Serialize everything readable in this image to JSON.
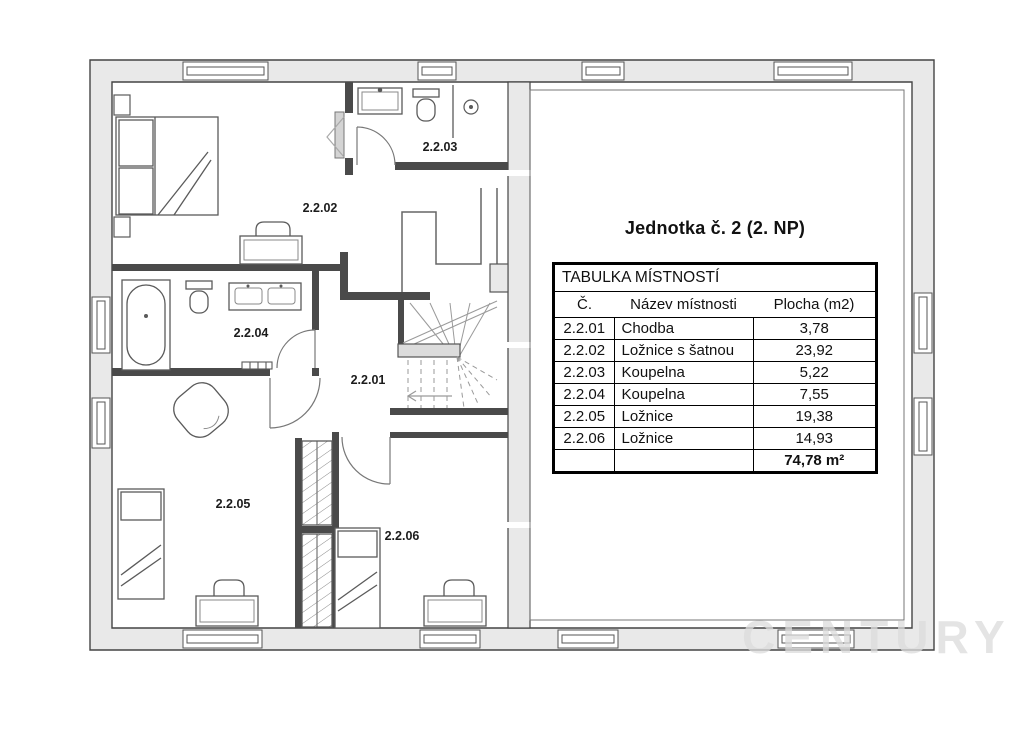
{
  "title": "Jednotka č. 2 (2. NP)",
  "table": {
    "caption": "TABULKA MÍSTNOSTÍ",
    "columns": [
      "Č.",
      "Název místnosti",
      "Plocha (m2)"
    ],
    "rows": [
      {
        "no": "2.2.01",
        "name": "Chodba",
        "area": "3,78"
      },
      {
        "no": "2.2.02",
        "name": "Ložnice s šatnou",
        "area": "23,92"
      },
      {
        "no": "2.2.03",
        "name": "Koupelna",
        "area": "5,22"
      },
      {
        "no": "2.2.04",
        "name": "Koupelna",
        "area": "7,55"
      },
      {
        "no": "2.2.05",
        "name": "Ložnice",
        "area": "19,38"
      },
      {
        "no": "2.2.06",
        "name": "Ložnice",
        "area": "14,93"
      }
    ],
    "total_area": "74,78 m²"
  },
  "plan": {
    "rooms": [
      {
        "label": "2.2.01"
      },
      {
        "label": "2.2.02"
      },
      {
        "label": "2.2.03"
      },
      {
        "label": "2.2.04"
      },
      {
        "label": "2.2.05"
      },
      {
        "label": "2.2.06"
      }
    ]
  },
  "watermark": "CENTURY 21",
  "colors": {
    "wall_fill": "#e9e9e9",
    "wall_line": "#444444",
    "furniture_line": "#5a5a5a",
    "table_border": "#000000"
  }
}
